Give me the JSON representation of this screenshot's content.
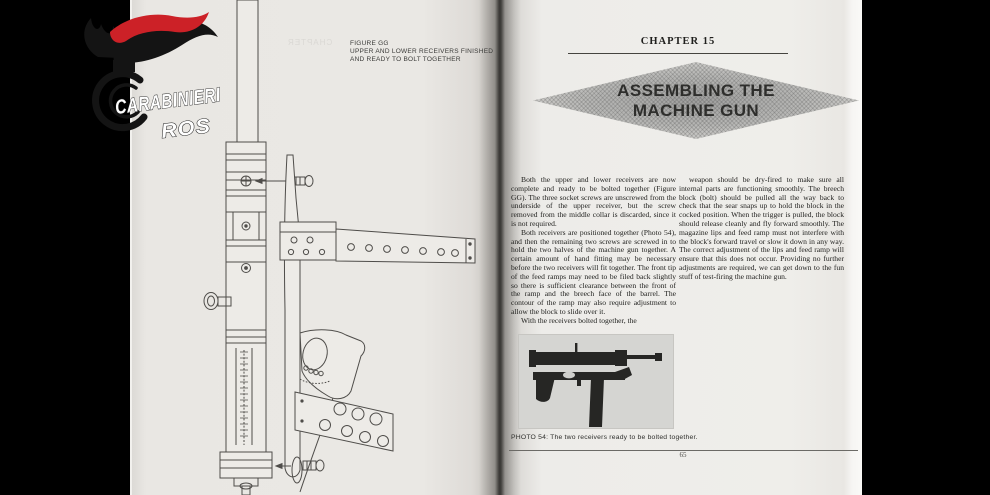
{
  "colors": {
    "letterbox": "#000000",
    "page": "#eae8e4",
    "logo_red": "#cc2127",
    "logo_black": "#141414",
    "ink": "#1d1d1b"
  },
  "logo": {
    "title": "CARABINIERI",
    "subtitle": "ROS"
  },
  "left_page": {
    "figure_caption": [
      "FIGURE GG",
      "UPPER AND LOWER RECEIVERS FINISHED",
      "AND READY TO BOLT TOGETHER"
    ],
    "bleedthrough_text": "CHAPTER"
  },
  "right_page": {
    "chapter_header": "CHAPTER 15",
    "title_lines": [
      "ASSEMBLING THE",
      "MACHINE GUN"
    ],
    "columns": {
      "col1_paragraphs": [
        "Both the upper and lower receivers are now complete and ready to be bolted together (Figure GG). The three socket screws are unscrewed from the underside of the upper receiver, but the screw removed from the middle collar is discarded, since it is not required.",
        "Both receivers are positioned together (Photo 54), and then the remaining two screws are screwed in to hold the two halves of the machine gun together. A certain amount of hand fitting may be necessary before the two receivers will fit together. The front tip of the feed ramps may need to be filed back slightly so there is sufficient clearance between the front of the ramp and the breech face of the barrel. The contour of the ramp may also require adjustment to allow the block to slide over it.",
        "With the receivers bolted together, the"
      ],
      "col2_paragraphs": [
        "weapon should be dry-fired to make sure all internal parts are functioning smoothly. The breech block (bolt) should be pulled all the way back to check that the sear snaps up to hold the block in the cocked position. When the trigger is pulled, the block should release cleanly and fly forward smoothly. The magazine lips and feed ramp must not interfere with the block's forward travel or slow it down in any way. The correct adjustment of the lips and feed ramp will ensure that this does not occur. Providing no further adjustments are required, we can get down to the fun stuff of test-firing the machine gun."
      ]
    },
    "photo_caption": "PHOTO 54: The two receivers ready to be bolted together.",
    "page_number": "65"
  }
}
